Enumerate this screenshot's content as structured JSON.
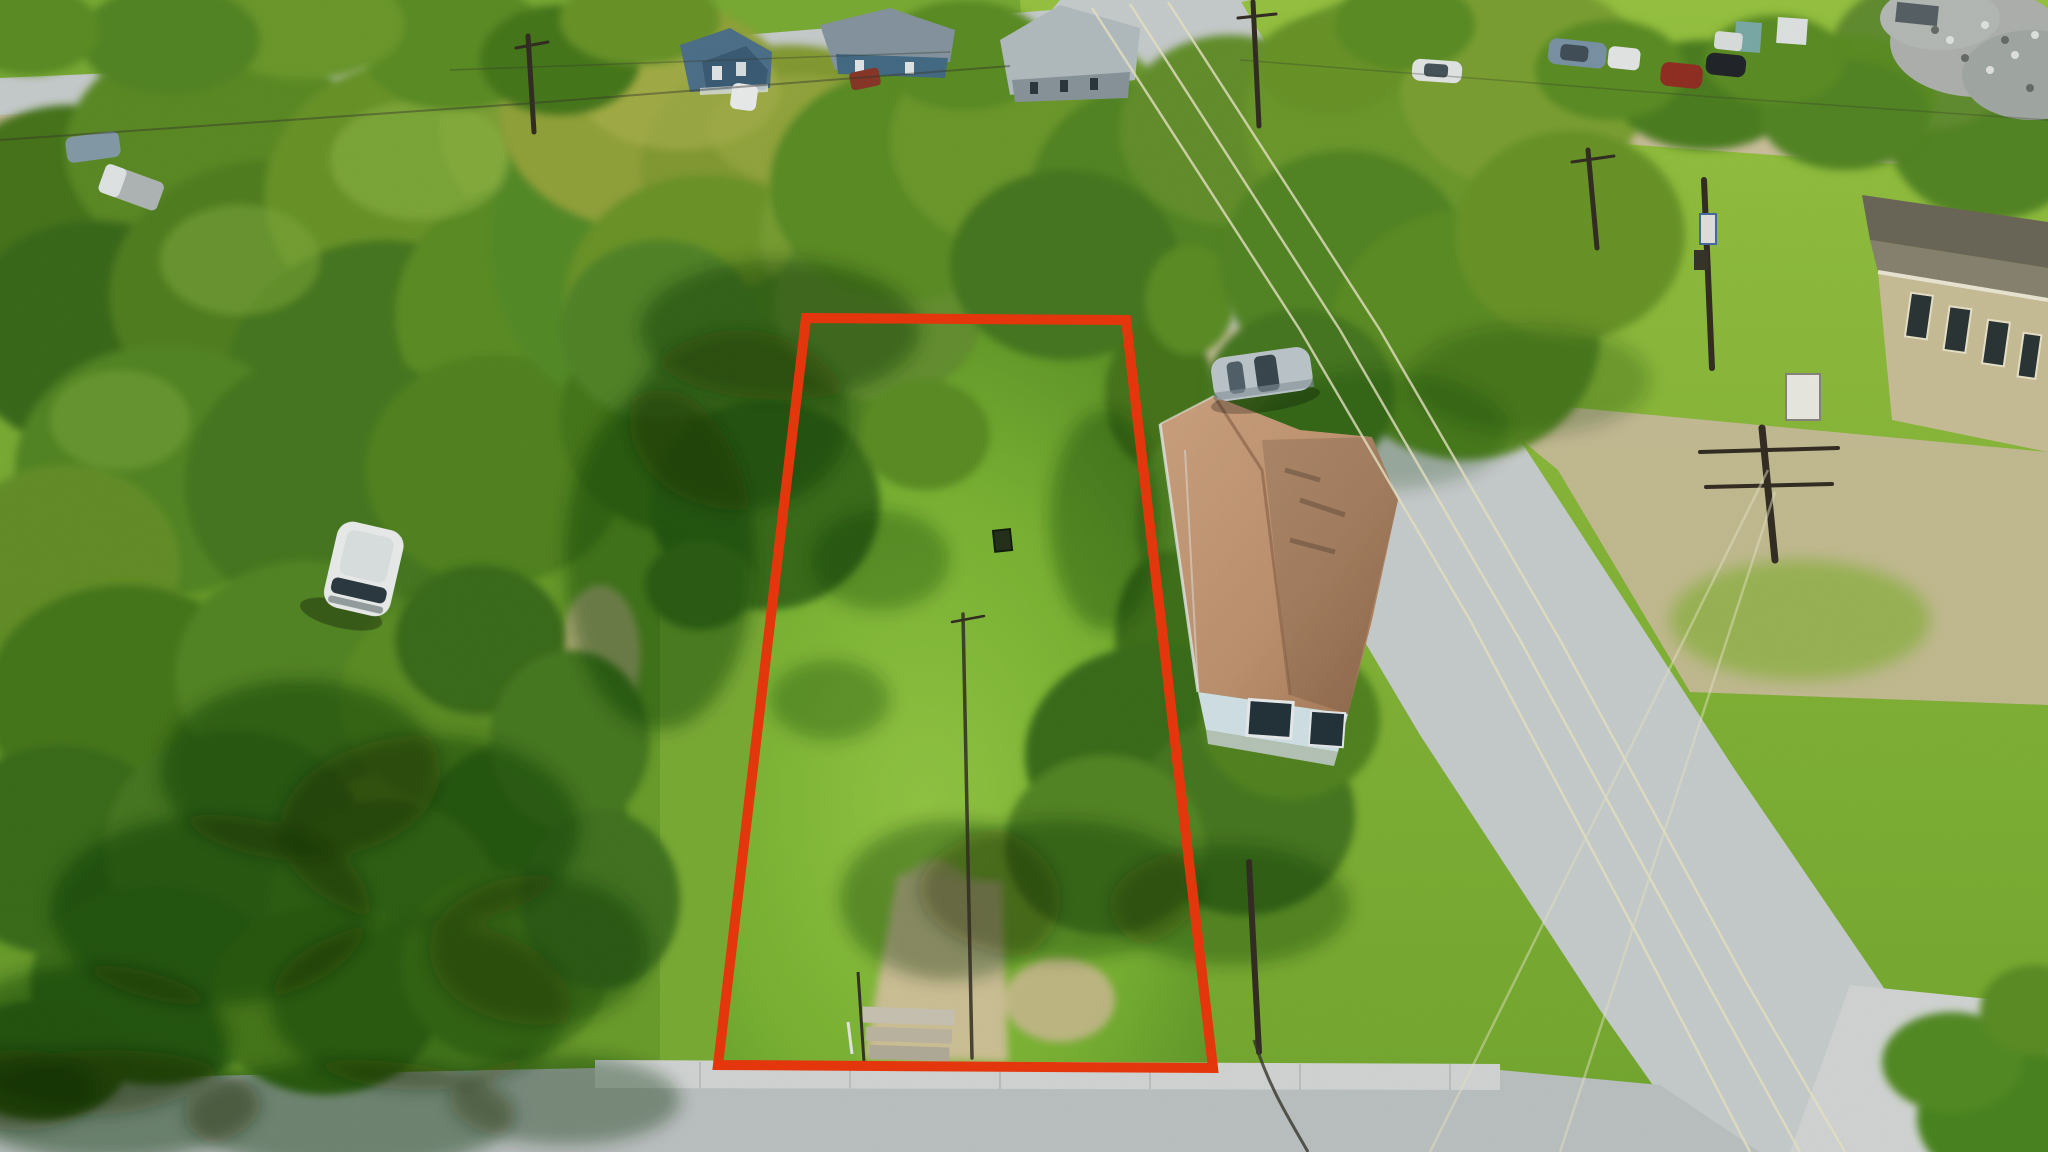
{
  "scene": {
    "type": "aerial-drone-photograph",
    "subject": "vacant residential lot outlined in red",
    "setting": "small-town residential neighborhood with mature trees, streets on top, bottom and right",
    "no_visible_text": true
  },
  "colors": {
    "boundary_red": "#f23a0e",
    "grass_base": "#7fb238",
    "grass_sunlit": "#95ca45",
    "grass_shaded": "#4c8021",
    "road_asphalt": "#ced3d3",
    "road_concrete": "#d9dddb",
    "dirt_tan": "#d3c6a4",
    "gravel": "#cfc2a0",
    "roof_shingle_light": "#cb9d7c",
    "roof_shingle_dark": "#a87a58",
    "house_wall": "#d8e9ee",
    "window_dark": "#26343c",
    "vehicle_white": "#f2f5f4",
    "vehicle_silver": "#c3ced2",
    "pole_brown": "#352f24",
    "wire_glint": "#efeccb"
  },
  "boundary": {
    "label": "property-boundary-outline",
    "points": "806,318 1126,320 1213,1068 718,1065",
    "stroke_width": 10
  },
  "objects": {
    "vacant_lot": "grassy vacant lot inside red outline with dirt path and old steps at street",
    "neighbor_house": "single-story house with brown shingle roof and light-blue gable wall",
    "silver_car": "silver hatchback parked on dirt behind house",
    "white_minivan": "white minivan parked on grass at left",
    "streets": [
      "street along top edge",
      "street along bottom edge",
      "diagonal street on right"
    ],
    "utility": "wood and steel utility poles with overhead power lines",
    "salvage_pile": "gray scrap pile at top right",
    "commercial_building": "tan flat building at top right corner"
  }
}
